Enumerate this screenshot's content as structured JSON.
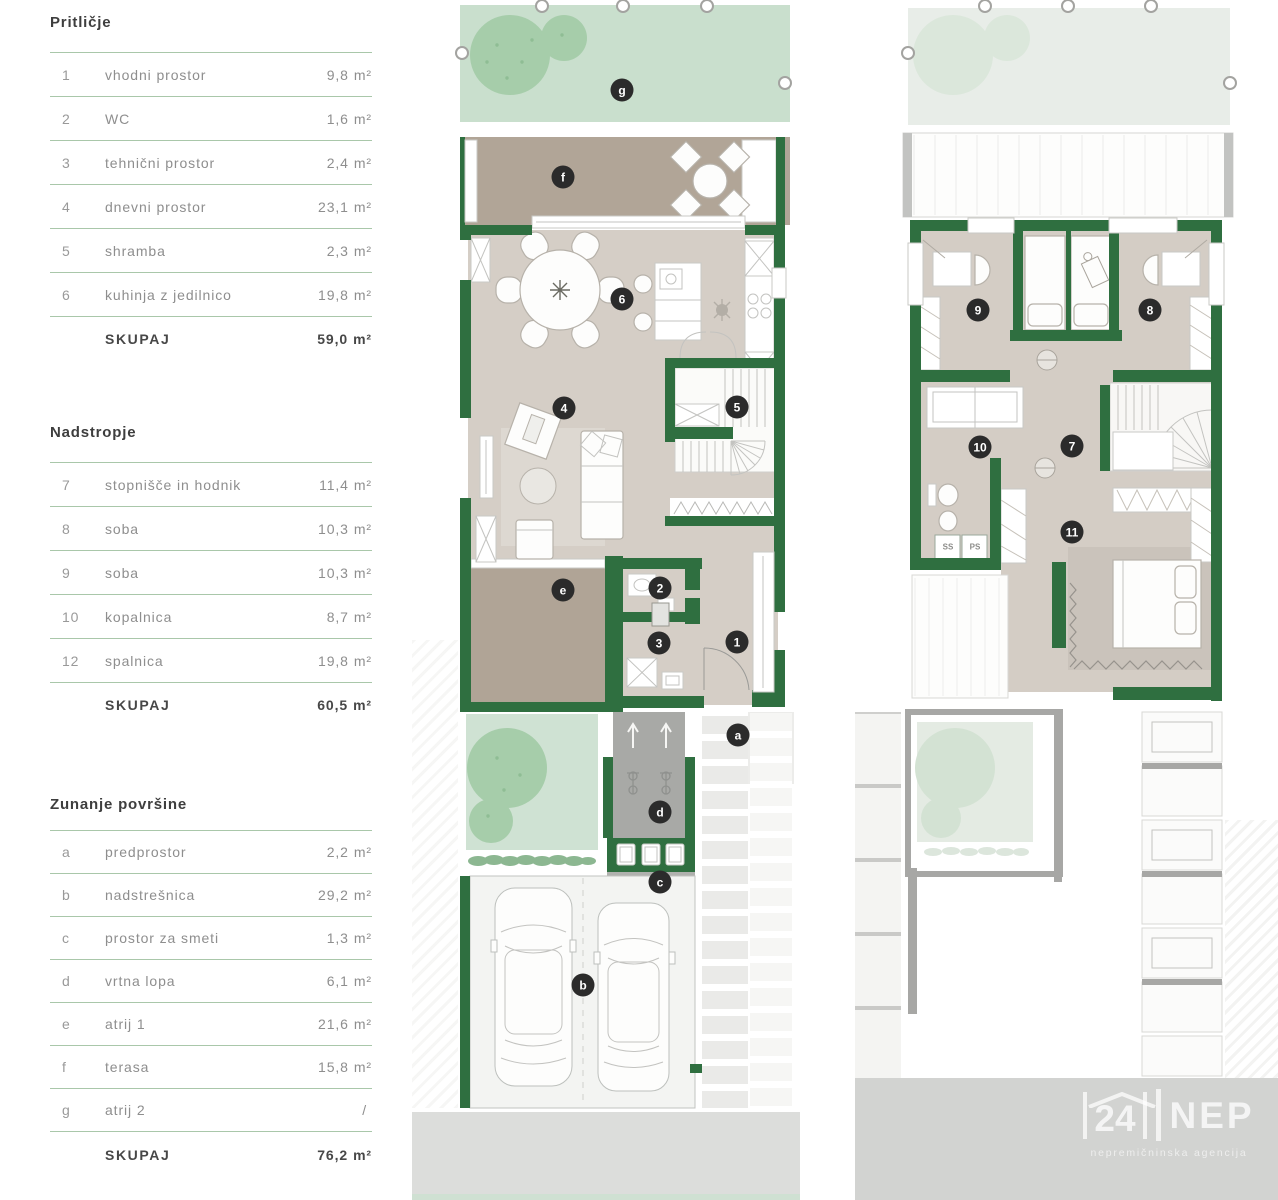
{
  "tables": [
    {
      "title": "Pritličje",
      "rows": [
        {
          "num": "1",
          "name": "vhodni prostor",
          "value": "9,8",
          "unit": "m²"
        },
        {
          "num": "2",
          "name": "WC",
          "value": "1,6",
          "unit": "m²"
        },
        {
          "num": "3",
          "name": "tehnični prostor",
          "value": "2,4",
          "unit": "m²"
        },
        {
          "num": "4",
          "name": "dnevni prostor",
          "value": "23,1",
          "unit": "m²"
        },
        {
          "num": "5",
          "name": "shramba",
          "value": "2,3",
          "unit": "m²"
        },
        {
          "num": "6",
          "name": "kuhinja z jedilnico",
          "value": "19,8",
          "unit": "m²"
        }
      ],
      "total_label": "SKUPAJ",
      "total_value": "59,0",
      "total_unit": "m²"
    },
    {
      "title": "Nadstropje",
      "rows": [
        {
          "num": "7",
          "name": "stopnišče in hodnik",
          "value": "11,4",
          "unit": "m²"
        },
        {
          "num": "8",
          "name": "soba",
          "value": "10,3",
          "unit": "m²"
        },
        {
          "num": "9",
          "name": "soba",
          "value": "10,3",
          "unit": "m²"
        },
        {
          "num": "10",
          "name": "kopalnica",
          "value": "8,7",
          "unit": "m²"
        },
        {
          "num": "12",
          "name": "spalnica",
          "value": "19,8",
          "unit": "m²"
        }
      ],
      "total_label": "SKUPAJ",
      "total_value": "60,5",
      "total_unit": "m²"
    },
    {
      "title": "Zunanje površine",
      "rows": [
        {
          "num": "a",
          "name": "predprostor",
          "value": "2,2",
          "unit": "m²"
        },
        {
          "num": "b",
          "name": "nadstrešnica",
          "value": "29,2",
          "unit": "m²"
        },
        {
          "num": "c",
          "name": "prostor za smeti",
          "value": "1,3",
          "unit": "m²"
        },
        {
          "num": "d",
          "name": "vrtna lopa",
          "value": "6,1",
          "unit": "m²"
        },
        {
          "num": "e",
          "name": "atrij 1",
          "value": "21,6",
          "unit": "m²"
        },
        {
          "num": "f",
          "name": "terasa",
          "value": "15,8",
          "unit": "m²"
        },
        {
          "num": "g",
          "name": "atrij 2",
          "value": "/",
          "unit": ""
        }
      ],
      "total_label": "SKUPAJ",
      "total_value": "76,2",
      "total_unit": "m²"
    }
  ],
  "ground_plan": {
    "labels": [
      {
        "text": "g"
      },
      {
        "text": "f"
      },
      {
        "text": "6"
      },
      {
        "text": "4"
      },
      {
        "text": "5"
      },
      {
        "text": "2"
      },
      {
        "text": "3"
      },
      {
        "text": "1"
      },
      {
        "text": "e"
      },
      {
        "text": "a"
      },
      {
        "text": "d"
      },
      {
        "text": "c"
      },
      {
        "text": "b"
      }
    ]
  },
  "upper_plan": {
    "labels": [
      {
        "text": "9"
      },
      {
        "text": "8"
      },
      {
        "text": "10"
      },
      {
        "text": "7"
      },
      {
        "text": "11"
      }
    ],
    "appliances": [
      {
        "text": "SS"
      },
      {
        "text": "PS"
      }
    ]
  },
  "logo": {
    "number": "24",
    "name": "NEP",
    "subtitle": "nepremičninska agencija"
  },
  "colors": {
    "wall_green": "#2f6f40",
    "atrium_green": "#c9dfcd",
    "terrace_brown": "#b1a597",
    "floor_beige": "#d5cec6",
    "label_circle": "#2b2b2b",
    "table_line": "#a9c7aa"
  }
}
